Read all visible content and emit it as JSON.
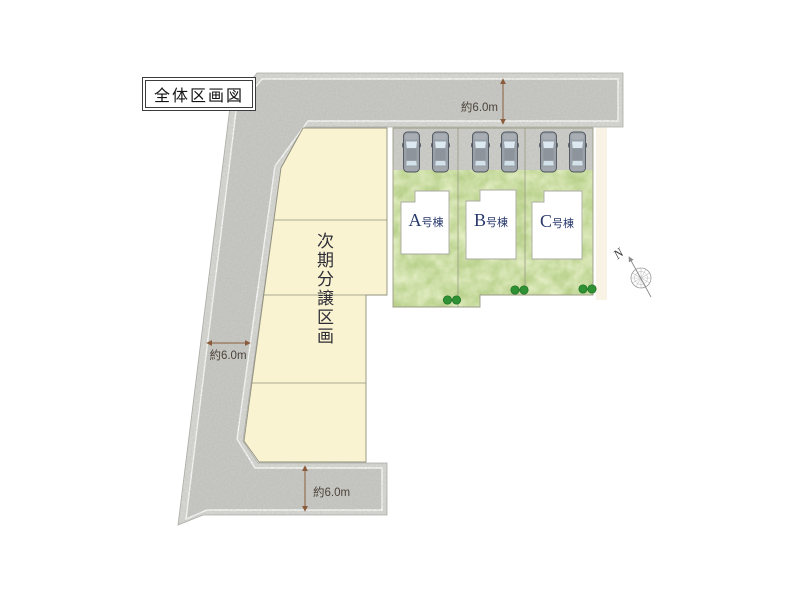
{
  "title": "全体区画図",
  "site": {
    "next_phase_label": "次期分譲区画",
    "lots": [
      {
        "letter": "A",
        "suffix": "号棟"
      },
      {
        "letter": "B",
        "suffix": "号棟"
      },
      {
        "letter": "C",
        "suffix": "号棟"
      }
    ],
    "dimensions": {
      "top_road": "約6.0m",
      "left_road": "約6.0m",
      "bottom_road": "約6.0m"
    },
    "compass_label": "N",
    "colors": {
      "road_fill": "#c9cac6",
      "road_edge_band": "#dadad6",
      "road_edge_line": "#ffffff",
      "next_phase_fill": "#faf3d2",
      "boundary_line": "#91917e",
      "lot_grass": "#bad28e",
      "grass_mottle": "#d9e8a3",
      "house_fill": "#ffffff",
      "lot_label_navy": "#28376b",
      "dimension_brown": "#8a5c3c",
      "dimension_text": "#4d4339",
      "bush_green": "#2f9133",
      "car_body": "#99a0a7",
      "car_window": "#dde9f0"
    }
  }
}
